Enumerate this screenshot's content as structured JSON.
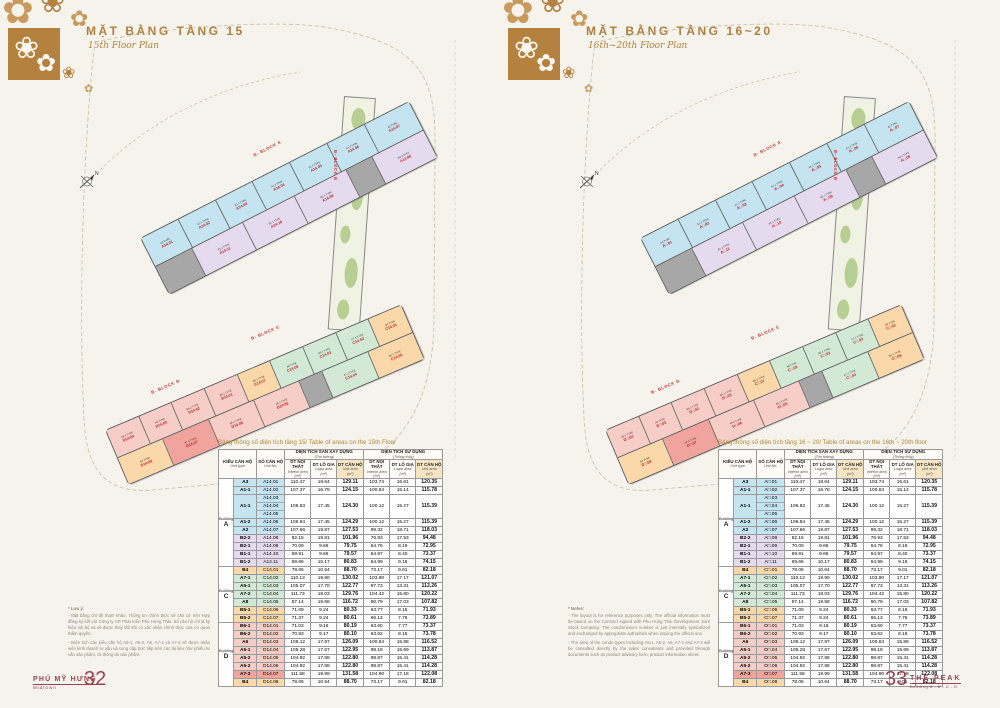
{
  "spine_text": "JAN 2/2018",
  "brand_colors": {
    "gold": "#b5813f",
    "maroon": "#9b4050",
    "red_label": "#c02424",
    "swoosh_orange": "#e0762f"
  },
  "pages": [
    {
      "header": {
        "title": "MẶT BẰNG TẦNG 15",
        "subtitle": "15th Floor Plan"
      },
      "table_title": "Bảng thông số diện tích tầng 15/ Table of areas on the 15th Floor",
      "note": {
        "head": "* Lưu ý:",
        "p1": "- Mặt bằng chỉ để tham khảo. Thông tin chính thức sẽ căn cứ trên Hợp đồng ký kết với Công ty CP Phát triển Phú Hưng Thái. Số căn hộ chỉ là ký hiệu nội bộ và sẽ được thay đổi khi có xác nhận chính thức của cơ quan thẩm quyền.",
        "p2": "- Diện tích các kiểu căn hộ A5-1, A5-2, A6, A7-2 và A7-3 sẽ được nhân viên kinh doanh tư vấn và cung cấp trực tiếp trên các tài liệu như phiếu tư vấn sản phẩm, tờ thông tin sản phẩm."
      },
      "footer": {
        "left": {
          "brand": "PHÚ MỸ HƯNG",
          "brand_sub": "Midtown",
          "page_number": "32"
        },
        "right": {
          "brand": "",
          "brand_sub": "",
          "page_number": ""
        }
      }
    },
    {
      "header": {
        "title": "MẶT BẰNG TẦNG 16~20",
        "subtitle": "16th~20th Floor Plan"
      },
      "table_title": "Bảng thông số diện tích tầng 16 ~ 20/ Table of areas on the 16th ~ 20th floor",
      "note": {
        "head": "* Notes:",
        "p1": "- The layout is for reference purposes only. The official information must be based on the Contract signed with Phu Hung Thai Development Joint Stock Company. The condominium number is just internally symbolized and exchanged by appropriate authorities when issuing the official one.",
        "p2": "- The area of the condo types including A5-1, A5-2, A6, A7-2 and A7-3 will be consulted directly by the sales consultants and provided through documents such as product advisory form, product information sheet."
      },
      "footer": {
        "left": {
          "brand": "",
          "brand_sub": "",
          "page_number": ""
        },
        "right": {
          "brand": "THE PEAK",
          "brand_sub": "Building A - B - C - D",
          "page_number": "33"
        }
      }
    }
  ],
  "plan": {
    "compass": "N",
    "block_labels": {
      "a": "B- BLOCK A",
      "b": "B- BLOCK B",
      "c": "B- BLOCK C",
      "d": "B- BLOCK D"
    },
    "strips": {
      "top": [
        [
          {
            "t": "A3 TYPE",
            "n": "A14.01",
            "nt": "A□.01",
            "c": "cyan"
          },
          {
            "t": "A1-1 TYPE",
            "n": "A14.02",
            "nt": "A□.02",
            "c": "cyan"
          },
          {
            "t": "A1-1 TYPE",
            "n": "A14.03",
            "nt": "A□.03",
            "c": "cyan"
          },
          {
            "t": "A1-1 TYPE",
            "n": "A14.04",
            "nt": "A□.04",
            "c": "cyan"
          },
          {
            "t": "A1-1 TYPE",
            "n": "A14.05",
            "nt": "A□.05",
            "c": "cyan"
          },
          {
            "t": "A1-2 TYPE",
            "n": "A14.06",
            "nt": "A□.06",
            "c": "cyan"
          },
          {
            "t": "A2 TYPE",
            "n": "A14.07",
            "nt": "A□.07",
            "c": "cyan",
            "w": 1.2
          }
        ],
        [
          {
            "c": "core",
            "w": 0.7
          },
          {
            "t": "B1-2 TYPE",
            "n": "A14.11",
            "nt": "A□.11",
            "c": "purple"
          },
          {
            "t": "B1-1 TYPE",
            "n": "A14.10",
            "nt": "A□.10",
            "c": "purple"
          },
          {
            "t": "B2-1 TYPE",
            "n": "A14.09",
            "nt": "A□.09",
            "c": "purple"
          },
          {
            "c": "core",
            "w": 0.5
          },
          {
            "t": "B2-2 TYPE",
            "n": "A14.08",
            "nt": "A□.08",
            "c": "purple"
          }
        ]
      ],
      "bottom": [
        [
          {
            "t": "A5-1 TYPE",
            "n": "D14.04",
            "nt": "D□.04",
            "c": "pink"
          },
          {
            "t": "A6 TYPE",
            "n": "D14.03",
            "nt": "D□.03",
            "c": "pink"
          },
          {
            "t": "B6-2 TYPE",
            "n": "D14.02",
            "nt": "D□.02",
            "c": "pink"
          },
          {
            "t": "B6-1 TYPE",
            "n": "D14.01",
            "nt": "D□.01",
            "c": "pink"
          },
          {
            "t": "B5-2 TYPE",
            "n": "C14.07",
            "nt": "C□.07",
            "c": "orange"
          },
          {
            "t": "A8 TYPE",
            "n": "C14.05",
            "nt": "C□.05",
            "c": "green"
          },
          {
            "t": "A5-1 TYPE",
            "n": "C14.03",
            "nt": "C□.03",
            "c": "green"
          },
          {
            "t": "A7-1 TYPE",
            "n": "C14.02",
            "nt": "C□.02",
            "c": "green"
          },
          {
            "t": "B4 TYPE",
            "n": "C14.01",
            "nt": "C□.01",
            "c": "orange"
          }
        ],
        [
          {
            "t": "B4 TYPE",
            "n": "D14.08",
            "nt": "D□.08",
            "c": "orange"
          },
          {
            "t": "A7-3 TYPE",
            "n": "D14.07",
            "nt": "D□.07",
            "c": "red"
          },
          {
            "t": "A5-2 TYPE",
            "n": "D14.06",
            "nt": "D□.06",
            "c": "pink"
          },
          {
            "t": "A5-2 TYPE",
            "n": "D14.05",
            "nt": "D□.05",
            "c": "pink"
          },
          {
            "c": "core",
            "w": 0.5
          },
          {
            "t": "A7-2 TYPE",
            "n": "C14.04",
            "nt": "C□.04",
            "c": "green"
          },
          {
            "t": "B5-1 TYPE",
            "n": "C14.06",
            "nt": "C□.06",
            "c": "orange"
          }
        ]
      ]
    }
  },
  "area_table": {
    "header": {
      "col1": {
        "vi": "KIỂU CĂN HỘ",
        "en": "Unit type"
      },
      "col2": {
        "vi": "SỐ CĂN HỘ",
        "en": "Unit No."
      },
      "group1": {
        "vi": "DIỆN TÍCH SÀN XÂY DỰNG",
        "en": "(Tim tường)"
      },
      "group2": {
        "vi": "DIỆN TÍCH SỬ DỤNG",
        "en": "(Thông thủy)"
      },
      "subcols": [
        {
          "vi": "DT NỘI THẤT",
          "en": "Interior area",
          "unit": "(m²)"
        },
        {
          "vi": "DT LÔ GIA",
          "en": "Logia area",
          "unit": "(m²)"
        },
        {
          "vi": "DT CĂN HỘ",
          "en": "Unit area",
          "unit": "(m²)"
        }
      ]
    },
    "groups": [
      {
        "b_word": "Building",
        "b_letter": "A",
        "rows": [
          {
            "type": "A3",
            "units": [
              "A14.01"
            ],
            "ut": [
              "A□.01"
            ],
            "color": "cyan",
            "v": [
              "110.47",
              "18.64",
              "129.11",
              "103.74",
              "16.61",
              "120.35"
            ]
          },
          {
            "type": "A1-1",
            "units": [
              "A14.02"
            ],
            "ut": [
              "A□.02"
            ],
            "color": "cyan",
            "v": [
              "107.37",
              "16.78",
              "124.15",
              "100.64",
              "15.14",
              "115.78"
            ]
          },
          {
            "type": "A1-1",
            "units": [
              "A14.03",
              "A14.04",
              "A14.05"
            ],
            "ut": [
              "A□.03",
              "A□.04",
              "A□.05"
            ],
            "color": "cyan",
            "v": [
              "106.83",
              "17.45",
              "124.30",
              "100.12",
              "15.27",
              "115.39"
            ]
          },
          {
            "type": "A1-2",
            "units": [
              "A14.06"
            ],
            "ut": [
              "A□.06"
            ],
            "color": "cyan",
            "v": [
              "106.84",
              "17.45",
              "124.29",
              "100.12",
              "15.27",
              "115.39"
            ]
          },
          {
            "type": "A2",
            "units": [
              "A14.07"
            ],
            "ut": [
              "A□.07"
            ],
            "color": "cyan",
            "v": [
              "107.66",
              "19.87",
              "127.53",
              "99.32",
              "18.71",
              "118.03"
            ]
          },
          {
            "type": "B2-2",
            "units": [
              "A14.08"
            ],
            "ut": [
              "A□.08"
            ],
            "color": "purple",
            "v": [
              "82.15",
              "19.81",
              "101.96",
              "76.93",
              "17.53",
              "94.48"
            ]
          },
          {
            "type": "B2-1",
            "units": [
              "A14.09"
            ],
            "ut": [
              "A□.09"
            ],
            "color": "purple",
            "v": [
              "70.09",
              "9.66",
              "79.75",
              "64.76",
              "8.19",
              "72.95"
            ]
          },
          {
            "type": "B1-1",
            "units": [
              "A14.10"
            ],
            "ut": [
              "A□.10"
            ],
            "color": "purple",
            "v": [
              "69.91",
              "9.66",
              "79.57",
              "64.97",
              "8.40",
              "73.37"
            ]
          },
          {
            "type": "B1-2",
            "units": [
              "A14.11"
            ],
            "ut": [
              "A□.11"
            ],
            "color": "purple",
            "v": [
              "69.66",
              "10.17",
              "80.83",
              "64.99",
              "9.16",
              "74.15"
            ]
          }
        ]
      },
      {
        "b_word": "Building",
        "b_letter": "C",
        "rows": [
          {
            "type": "B4",
            "units": [
              "C14.01"
            ],
            "ut": [
              "C□.01"
            ],
            "color": "orange",
            "v": [
              "78.06",
              "10.64",
              "88.70",
              "73.17",
              "9.01",
              "82.18"
            ]
          },
          {
            "type": "A7-1",
            "units": [
              "C14.02"
            ],
            "ut": [
              "C□.02"
            ],
            "color": "green",
            "v": [
              "110.12",
              "19.90",
              "130.02",
              "103.90",
              "17.17",
              "121.07"
            ]
          },
          {
            "type": "A5-1",
            "units": [
              "C14.03"
            ],
            "ut": [
              "C□.03"
            ],
            "color": "green",
            "v": [
              "105.07",
              "17.70",
              "122.77",
              "97.73",
              "13.31",
              "113.26"
            ]
          },
          {
            "type": "A7-2",
            "units": [
              "C14.04"
            ],
            "ut": [
              "C□.04"
            ],
            "color": "green",
            "v": [
              "111.73",
              "18.03",
              "129.76",
              "104.42",
              "15.80",
              "120.22"
            ]
          },
          {
            "type": "A8",
            "units": [
              "C14.05"
            ],
            "ut": [
              "C□.05"
            ],
            "color": "green",
            "v": [
              "97.14",
              "19.58",
              "116.72",
              "90.79",
              "17.03",
              "107.82"
            ]
          },
          {
            "type": "B5-1",
            "units": [
              "C14.06"
            ],
            "ut": [
              "C□.06"
            ],
            "color": "orange",
            "v": [
              "71.09",
              "9.24",
              "80.33",
              "63.77",
              "8.16",
              "71.93"
            ]
          },
          {
            "type": "B5-2",
            "units": [
              "C14.07"
            ],
            "ut": [
              "C□.07"
            ],
            "color": "orange",
            "v": [
              "71.37",
              "9.24",
              "80.61",
              "66.13",
              "7.76",
              "73.89"
            ]
          }
        ]
      },
      {
        "b_word": "Building",
        "b_letter": "D",
        "rows": [
          {
            "type": "B6-1",
            "units": [
              "D14.01"
            ],
            "ut": [
              "D□.01"
            ],
            "color": "pink",
            "v": [
              "71.03",
              "9.16",
              "80.19",
              "63.60",
              "7.77",
              "73.37"
            ]
          },
          {
            "type": "B6-2",
            "units": [
              "D14.02"
            ],
            "ut": [
              "D□.02"
            ],
            "color": "pink",
            "v": [
              "70.93",
              "9.17",
              "80.10",
              "63.62",
              "8.16",
              "73.78"
            ]
          },
          {
            "type": "A6",
            "units": [
              "D14.03"
            ],
            "ut": [
              "D□.03"
            ],
            "color": "pink",
            "v": [
              "108.12",
              "17.97",
              "126.09",
              "100.64",
              "15.88",
              "116.52"
            ]
          },
          {
            "type": "A5-1",
            "units": [
              "D14.04"
            ],
            "ut": [
              "D□.04"
            ],
            "color": "pink",
            "v": [
              "105.28",
              "17.67",
              "122.95",
              "98.18",
              "15.69",
              "113.87"
            ]
          },
          {
            "type": "A5-2",
            "units": [
              "D14.05"
            ],
            "ut": [
              "D□.05"
            ],
            "color": "pink",
            "v": [
              "104.92",
              "17.88",
              "122.80",
              "98.87",
              "15.41",
              "114.28"
            ]
          },
          {
            "type": "A5-2",
            "units": [
              "D14.06"
            ],
            "ut": [
              "D□.06"
            ],
            "color": "pink",
            "v": [
              "104.92",
              "17.88",
              "122.80",
              "98.87",
              "15.41",
              "114.28"
            ]
          },
          {
            "type": "A7-3",
            "units": [
              "D14.07"
            ],
            "ut": [
              "D□.07"
            ],
            "color": "red",
            "v": [
              "111.58",
              "19.99",
              "131.58",
              "104.90",
              "17.18",
              "122.08"
            ]
          },
          {
            "type": "B4",
            "units": [
              "D14.08"
            ],
            "ut": [
              "D□.08"
            ],
            "color": "orange",
            "v": [
              "78.06",
              "10.64",
              "88.70",
              "73.17",
              "9.01",
              "82.18"
            ]
          }
        ]
      }
    ]
  }
}
